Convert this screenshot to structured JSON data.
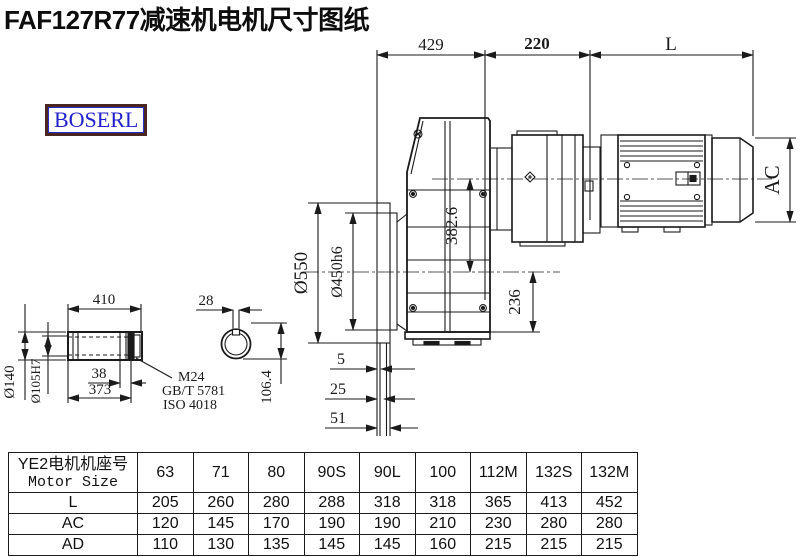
{
  "page": {
    "title": "FAF127R77减速机电机尺寸图纸",
    "logo": "BOSERL",
    "line_color": "#1a1a1a",
    "logo_border_color": "#4a2620",
    "logo_text_color": "#2222cc"
  },
  "drawing": {
    "top_dims": {
      "gearbox_length": "429",
      "adapter_length": "220",
      "motor_length": "L"
    },
    "side_dims": {
      "flange_od": "Ø550",
      "spigot_dia": "Ø450h6",
      "axis_offset": "382.6",
      "base_height": "236",
      "motor_frame": "AC",
      "flange_step_1": "5",
      "flange_step_2": "25",
      "flange_step_3": "51"
    },
    "shaft_dims": {
      "shaft_length": "410",
      "end_step": "38",
      "bore_length": "373",
      "shaft_od": "Ø140",
      "bore_dia": "Ø105H7",
      "key_width": "28",
      "key_depth": "106.4",
      "thread": "M24",
      "standard_gb": "GB/T 5781",
      "standard_iso": "ISO 4018"
    }
  },
  "table": {
    "header_cn": "YE2电机机座号",
    "header_en": "Motor Size",
    "columns": [
      "63",
      "71",
      "80",
      "90S",
      "90L",
      "100",
      "112M",
      "132S",
      "132M"
    ],
    "rows": [
      {
        "label": "L",
        "values": [
          "205",
          "260",
          "280",
          "288",
          "318",
          "318",
          "365",
          "413",
          "452"
        ]
      },
      {
        "label": "AC",
        "values": [
          "120",
          "145",
          "170",
          "190",
          "190",
          "210",
          "230",
          "280",
          "280"
        ]
      },
      {
        "label": "AD",
        "values": [
          "110",
          "130",
          "135",
          "145",
          "145",
          "160",
          "215",
          "215",
          "215"
        ]
      }
    ]
  }
}
